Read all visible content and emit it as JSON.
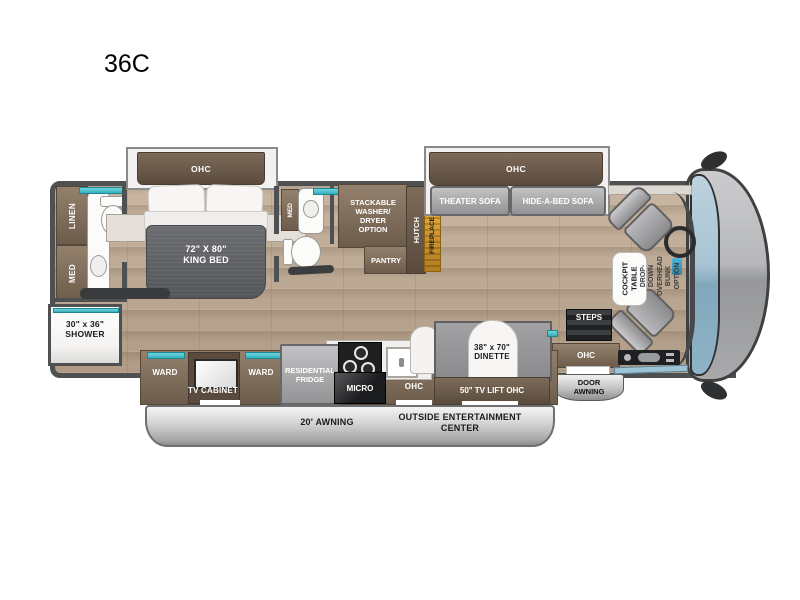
{
  "model_label": "36C",
  "colors": {
    "accent_teal": "#45c0cf",
    "fireplace_gold": "#d89a2e",
    "cabinet_brown": "#7b6a58",
    "body_gray": "#4f5052",
    "furniture_gray": "#a3a3a5",
    "floor_wood": "#bfab96",
    "awning_silver": "#c6c6c6",
    "windshield_blue": "#9cc0d2"
  },
  "slide_bedroom": {
    "ohc": "OHC"
  },
  "rear_bath": {
    "linen": "LINEN",
    "med": "MED"
  },
  "bedroom": {
    "bed_size": "72\" X 80\"",
    "bed_type": "KING BED"
  },
  "shower": {
    "size": "30\" x 36\"",
    "name": "SHOWER"
  },
  "mid_bath": {
    "med": "MED"
  },
  "utility": {
    "washer_dryer": "STACKABLE WASHER/ DRYER OPTION",
    "pantry": "PANTRY",
    "hutch": "HUTCH",
    "fireplace": "FIREPLACE"
  },
  "living": {
    "ohc": "OHC",
    "theater_sofa": "THEATER SOFA",
    "hide_a_bed_sofa": "HIDE-A-BED SOFA"
  },
  "cockpit": {
    "table": "COCKPIT TABLE",
    "bunk_option": "DROP-DOWN OVERHEAD BUNK OPTION"
  },
  "entry": {
    "steps": "STEPS",
    "ohc": "OHC",
    "door_awning": "DOOR AWNING"
  },
  "dinette": {
    "size": "38\" x 70\"",
    "name": "DINETTE",
    "tv_lift": "50\" TV LIFT OHC"
  },
  "kitchen": {
    "ohc": "OHC",
    "micro": "MICRO",
    "fridge": "RESIDENTIAL FRIDGE"
  },
  "cabinets": {
    "ward_left": "WARD",
    "tv_cabinet": "TV CABINET",
    "ward_right": "WARD"
  },
  "exterior": {
    "awning": "20' AWNING",
    "entertainment": "OUTSIDE ENTERTAINMENT CENTER"
  }
}
